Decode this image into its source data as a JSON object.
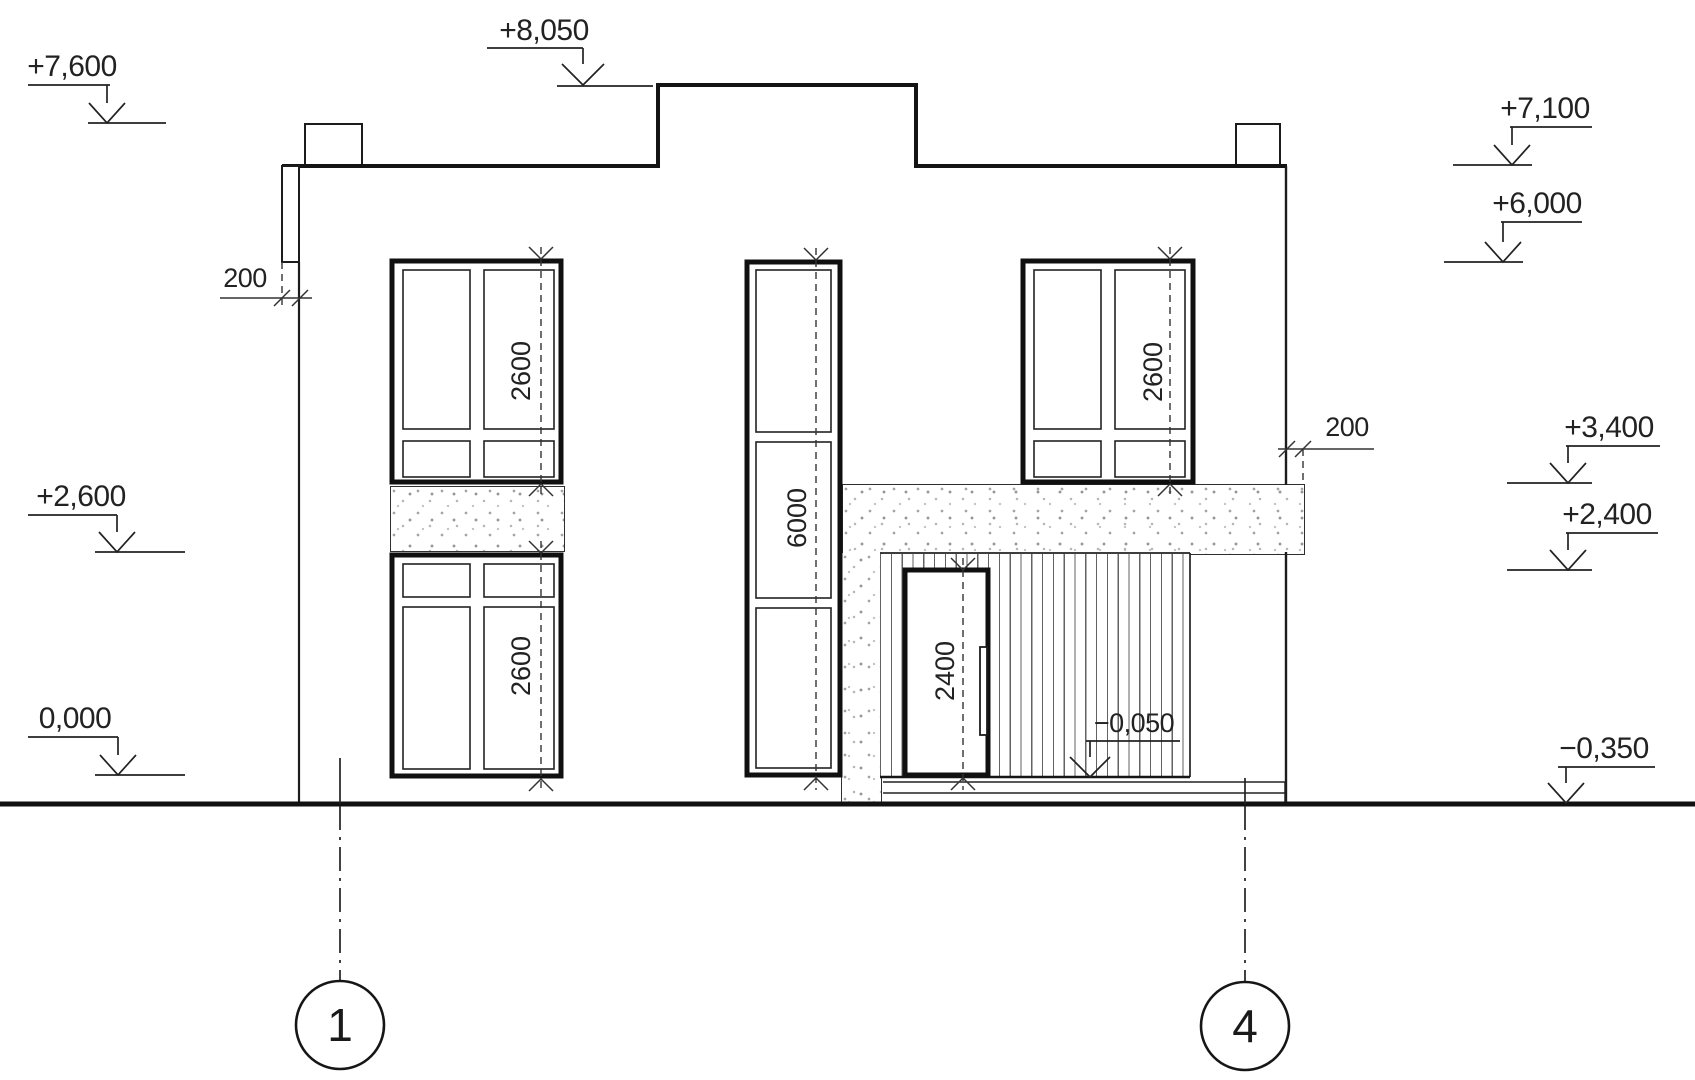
{
  "drawing": {
    "kind": "house facade elevation",
    "background": "#ffffff",
    "line_color": "#1c1c1c",
    "text_color": "#222222"
  },
  "markers": {
    "left": [
      {
        "label": "+7,600"
      },
      {
        "label": "+2,600"
      },
      {
        "label": "0,000"
      }
    ],
    "top": [
      {
        "label": "+8,050"
      }
    ],
    "right": [
      {
        "label": "+7,100"
      },
      {
        "label": "+6,000"
      },
      {
        "label": "+3,400"
      },
      {
        "label": "+2,400"
      },
      {
        "label": "−0,350"
      }
    ],
    "porch": {
      "label": "−0,050"
    }
  },
  "dimensions": {
    "parapet_left": "200",
    "beam_right": "200",
    "window_upper_left": "2600",
    "window_lower_left": "2600",
    "window_right": "2600",
    "window_center": "6000",
    "door": "2400"
  },
  "grid_axes": [
    {
      "label": "1"
    },
    {
      "label": "4"
    }
  ]
}
